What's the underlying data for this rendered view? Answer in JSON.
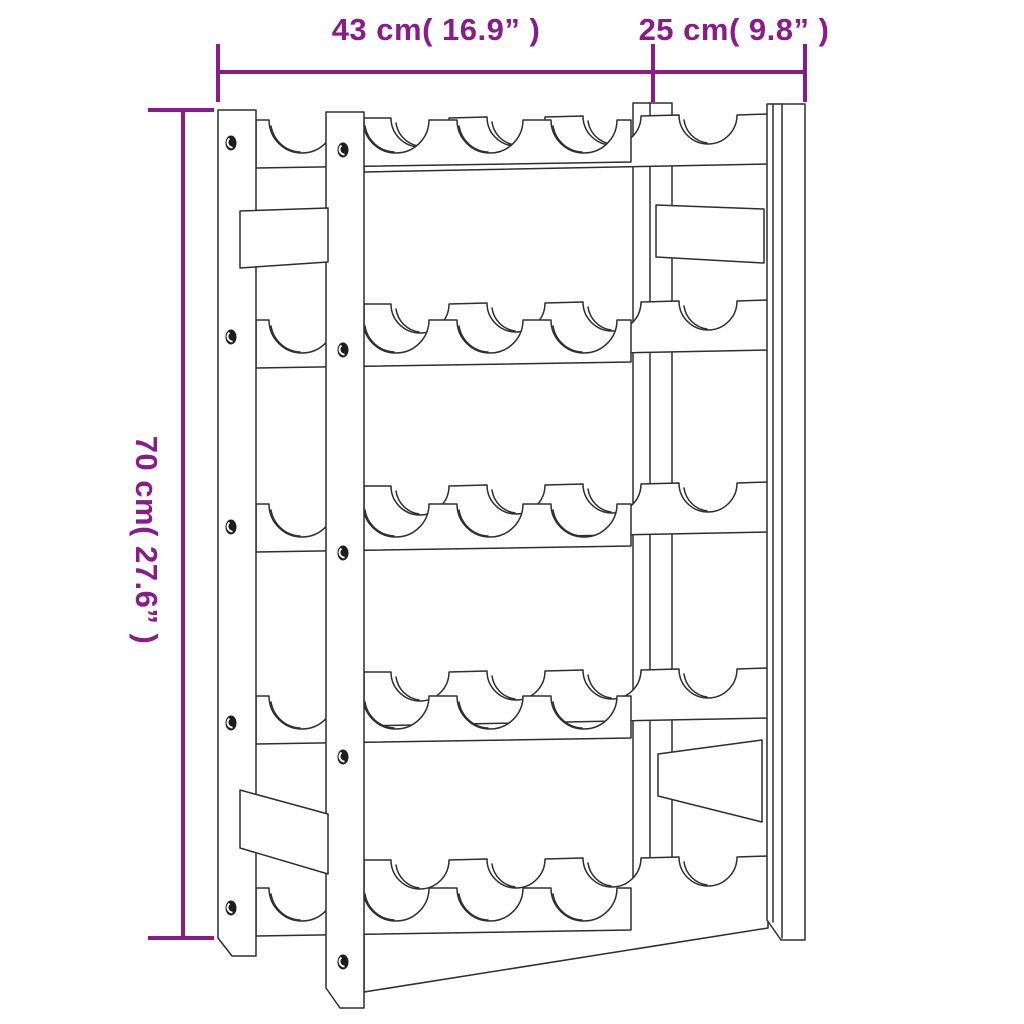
{
  "diagram": {
    "subject": "wine-rack-line-drawing",
    "rows_of_bottle_cradles": 5,
    "cradles_per_row": 4,
    "dimensions": {
      "width_label": "43 cm( 16.9” )",
      "depth_label": "25 cm( 9.8” )",
      "height_label": "70 cm( 27.6” )"
    },
    "colors": {
      "annotation_purple": "#8A1B8A",
      "line_art": "#2E2E2E",
      "background": "#FFFFFF"
    }
  }
}
